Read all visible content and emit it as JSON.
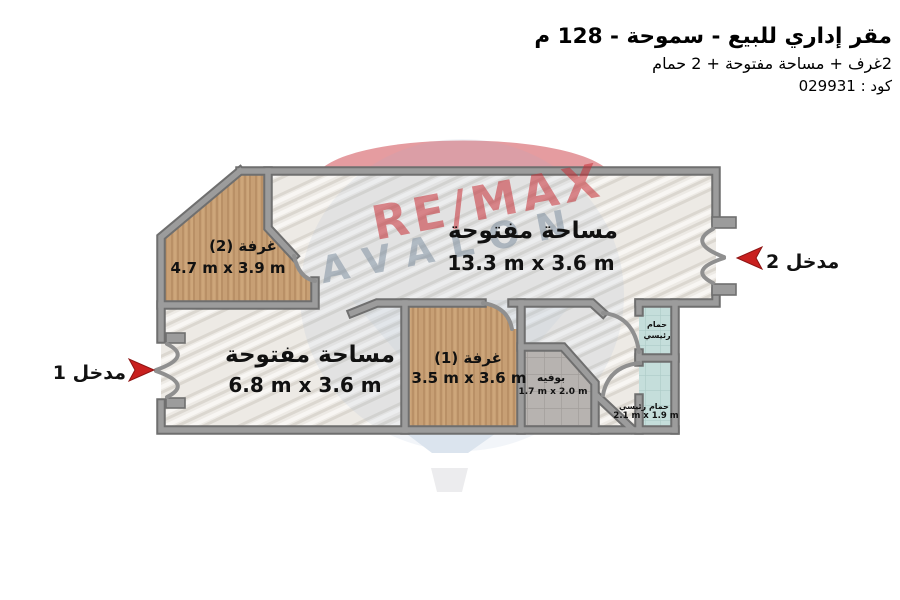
{
  "header": {
    "title": "مقر إداري للبيع - سموحة - 128 م",
    "subtitle": "2غرف + مساحة مفتوحة + 2 حمام",
    "code": "كود : 029931"
  },
  "watermark": {
    "brand": "RE/MAX",
    "name": "AVALON"
  },
  "entrances": {
    "e1": {
      "label": "مدخل 1"
    },
    "e2": {
      "label": "مدخل 2"
    }
  },
  "rooms": {
    "open_top": {
      "name": "مساحة مفتوحة",
      "dims": "13.3 m x 3.6 m"
    },
    "open_bottom": {
      "name": "مساحة مفتوحة",
      "dims": "6.8 m x 3.6 m"
    },
    "room2": {
      "name": "غرفة (2)",
      "dims": "4.7 m x 3.9 m"
    },
    "room1": {
      "name": "غرفة (1)",
      "dims": "3.5 m x 3.6 m"
    },
    "buffet": {
      "name": "بوفيه",
      "dims": "1.7 m x 2.0 m"
    },
    "bath_top": {
      "name": "حمام رئيسي"
    },
    "bath_bottom": {
      "name": "حمام رئيسي",
      "dims": "2.1 m x 1.9 m"
    }
  },
  "colors": {
    "arrow_red": "#c9201f",
    "wall_dark": "#6f6f6f",
    "wall_light": "#9c9c9c",
    "wood": "#c79f74",
    "marble": "#edeae5",
    "tile": "#b7b3b0",
    "bath": "#c5dedb",
    "watermark_red": "#c72e35",
    "watermark_blue": "#8f9fb0"
  }
}
